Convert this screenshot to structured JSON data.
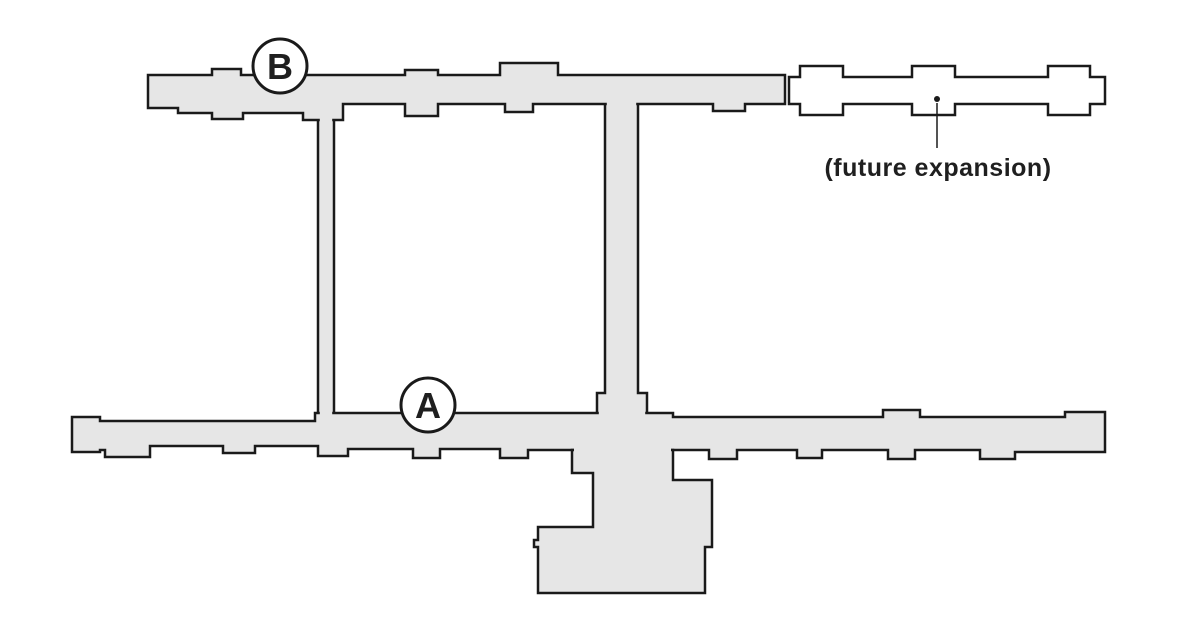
{
  "canvas": {
    "width": 1200,
    "height": 640,
    "background": "#ffffff"
  },
  "palette": {
    "building_fill": "#e6e6e6",
    "outline": "#1a1a1a",
    "future_fill": "#ffffff",
    "marker_fill": "#ffffff",
    "text_color": "#1f1f1f",
    "outline_width": 2.5,
    "marker_stroke_width": 3
  },
  "markers": [
    {
      "label": "B",
      "cx": 280,
      "cy": 66,
      "r": 27,
      "font_size": 36
    },
    {
      "label": "A",
      "cx": 428,
      "cy": 405,
      "r": 27,
      "font_size": 36
    }
  ],
  "annotation": {
    "text": "(future expansion)",
    "text_x": 938,
    "text_y": 176,
    "font_size": 25,
    "letter_spacing": 0.5,
    "dot": {
      "cx": 937,
      "cy": 99,
      "r": 3
    },
    "leader": {
      "x1": 937,
      "y1": 103,
      "x2": 937,
      "y2": 148,
      "width": 1.5
    }
  },
  "floorplan": {
    "shapes": [
      {
        "name": "future-expansion-wing",
        "fill": "future_fill",
        "stroked": true,
        "points": "789,77 800,77 800,66 843,66 843,77 912,77 912,66 955,66 955,77 1048,77 1048,66 1090,66 1090,77 1105,77 1105,104 1090,104 1090,115 1048,115 1048,104 955,104 955,115 912,115 912,104 843,104 843,115 800,115 800,104 789,104"
      },
      {
        "name": "corridor-west",
        "fill": "building_fill",
        "stroked": true,
        "points": "318,114 334,114 334,419 318,419"
      },
      {
        "name": "corridor-east",
        "fill": "building_fill",
        "stroked": true,
        "points": "605,100 638,100 638,393 647,393 647,417 597,417 597,393 605,393"
      },
      {
        "name": "wing-b-north",
        "fill": "building_fill",
        "stroked": true,
        "points": "148,75 212,75 212,69 241,69 241,75 405,75 405,70 438,70 438,75 500,75 500,63 558,63 558,75 785,75 785,104 745,104 745,111 713,111 713,104 533,104 533,112 505,112 505,104 438,104 438,116 405,116 405,104 343,104 343,120 303,120 303,113 243,113 243,119 212,119 212,113 178,113 178,108 148,108"
      },
      {
        "name": "wing-a-south",
        "fill": "building_fill",
        "stroked": true,
        "points": "72,417 100,417 100,421 315,421 315,413 673,413 673,417 883,417 883,410 920,410 920,417 1065,417 1065,412 1105,412 1105,452 1015,452 1015,459 980,459 980,450 915,450 915,459 888,459 888,450 822,450 822,458 797,458 797,450 737,450 737,459 709,459 709,450 528,450 528,458 500,458 500,449 440,449 440,458 413,458 413,449 348,449 348,456 318,456 318,446 255,446 255,453 223,453 223,446 150,446 150,457 105,457 105,450 100,450 100,452 72,452"
      },
      {
        "name": "south-extension",
        "fill": "building_fill",
        "stroked": true,
        "points": "572,450 572,473 593,473 593,527 538,527 538,540 534,540 534,547 538,547 538,593 705,593 705,547 712,547 712,480 673,480 673,450"
      },
      {
        "name": "join-patch-corridor-west-top",
        "fill": "building_fill",
        "stroked": false,
        "points": "319.8,116.5 332.2,116.5 332.2,123 319.8,123"
      },
      {
        "name": "join-patch-corridor-west-bottom",
        "fill": "building_fill",
        "stroked": false,
        "points": "319.8,410 332.2,410 332.2,416.5 319.8,416.5"
      },
      {
        "name": "join-patch-corridor-east-top",
        "fill": "building_fill",
        "stroked": false,
        "points": "606.8,101 636.2,101 636.2,107.5 606.8,107.5"
      },
      {
        "name": "join-patch-corridor-east-bottom",
        "fill": "building_fill",
        "stroked": false,
        "points": "598.8,410 645.2,410 645.2,416 598.8,416"
      },
      {
        "name": "join-patch-south-extension",
        "fill": "building_fill",
        "stroked": false,
        "points": "574,446.5 671,446.5 671,454 574,454"
      }
    ]
  }
}
